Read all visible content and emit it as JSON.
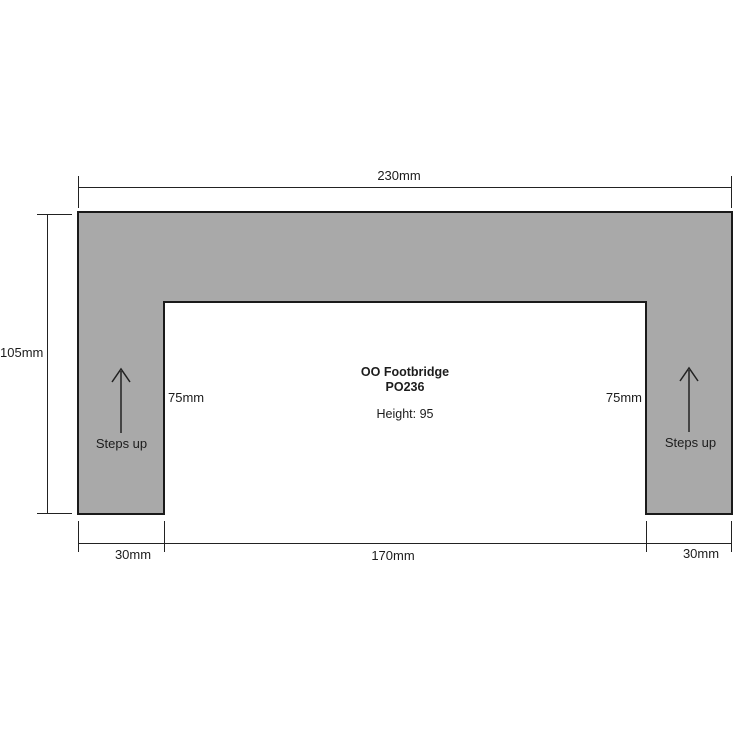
{
  "diagram": {
    "product": {
      "title": "OO Footbridge",
      "code": "PO236",
      "height_note": "Height: 95"
    },
    "dimensions": {
      "total_width": "230mm",
      "total_depth": "105mm",
      "left_leg_width": "30mm",
      "inner_span": "170mm",
      "right_leg_width": "30mm",
      "left_leg_depth": "75mm",
      "right_leg_depth": "75mm"
    },
    "annotations": {
      "left_steps": "Steps up",
      "right_steps": "Steps up"
    },
    "icons": {
      "left_arrow": "arrow-up-icon",
      "right_arrow": "arrow-up-icon"
    },
    "colors": {
      "footprint_fill": "#a9a9a9",
      "outline": "#1a1a1a",
      "dimension_lines": "#222222",
      "background": "#ffffff"
    }
  }
}
